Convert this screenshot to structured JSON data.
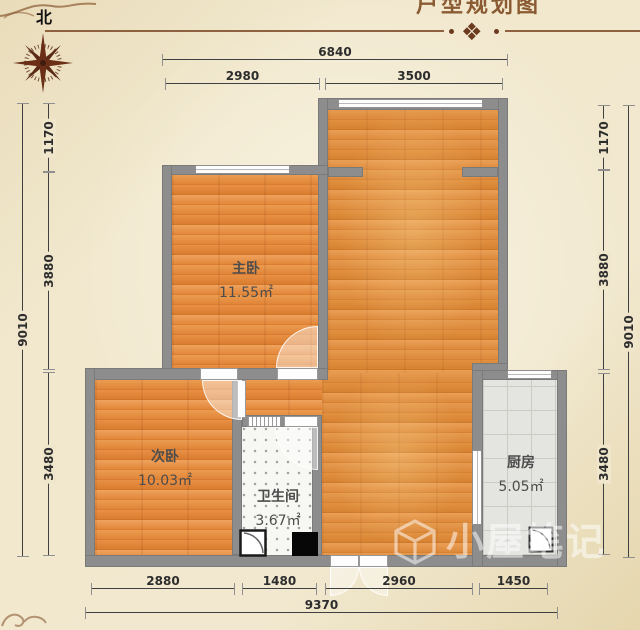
{
  "compass": {
    "label": "北"
  },
  "decor": {
    "title": "户型规划图",
    "ornament": "❖"
  },
  "rooms": {
    "master": {
      "name": "主卧",
      "area": "11.55㎡"
    },
    "second": {
      "name": "次卧",
      "area": "10.03㎡"
    },
    "bath": {
      "name": "卫生间",
      "area": "3.67㎡"
    },
    "kitchen": {
      "name": "厨房",
      "area": "5.05㎡"
    }
  },
  "dims": {
    "top": {
      "total": "6840",
      "seg1": "2980",
      "seg2": "3500"
    },
    "left": {
      "total": "9010",
      "seg1": "1170",
      "seg2": "3880",
      "seg3": "3480"
    },
    "right": {
      "total": "9010",
      "seg1": "1170",
      "seg2": "3880",
      "seg3": "3480"
    },
    "bottom": {
      "total": "9370",
      "seg1": "2880",
      "seg2": "1480",
      "seg3": "2960",
      "seg4": "1450"
    }
  },
  "watermark": {
    "text": "小屋笔记"
  },
  "colors": {
    "wall": "#8d8d8d",
    "wood": "#e0883c",
    "brown": "#7d4a28",
    "bg": "#efe5c9"
  }
}
